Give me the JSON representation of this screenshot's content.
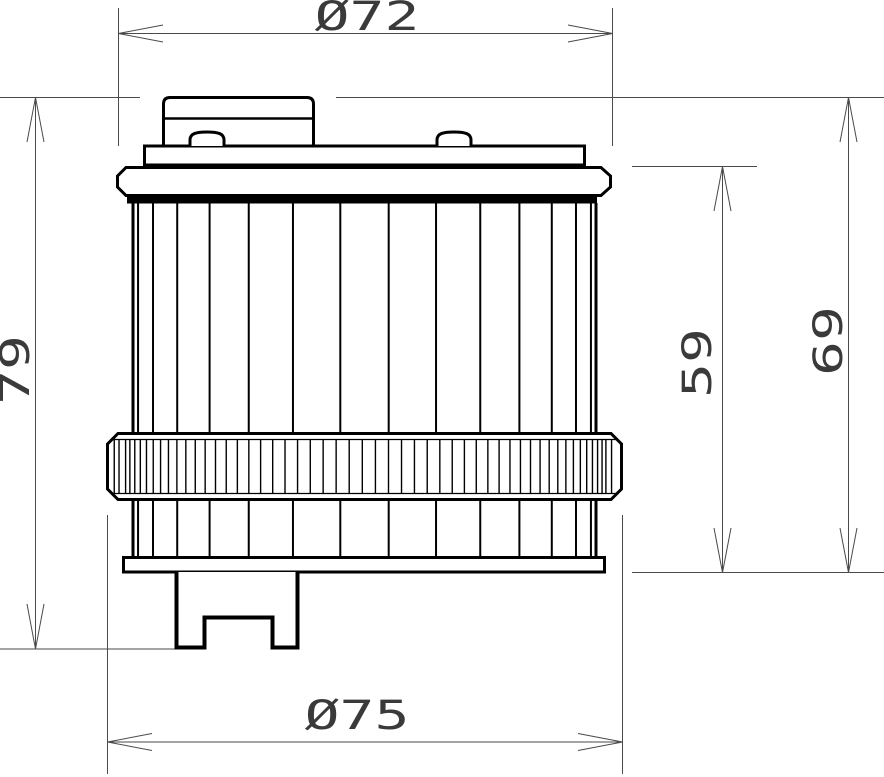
{
  "drawing": {
    "type": "technical-drawing",
    "subject": "oil-filter-side-view",
    "background_color": "#ffffff",
    "outline_color": "#000000",
    "dimension_line_color": "#4a4a4a",
    "label_color": "#3a3a3a",
    "dimensions": {
      "top_diameter": {
        "label": "Ø72",
        "value": 72
      },
      "bottom_diameter": {
        "label": "Ø75",
        "value": 75
      },
      "overall_height": {
        "label": "79",
        "value": 79
      },
      "flange_to_base_height": {
        "label": "59",
        "value": 59
      },
      "cap_to_base_height": {
        "label": "69",
        "value": 69
      }
    }
  }
}
